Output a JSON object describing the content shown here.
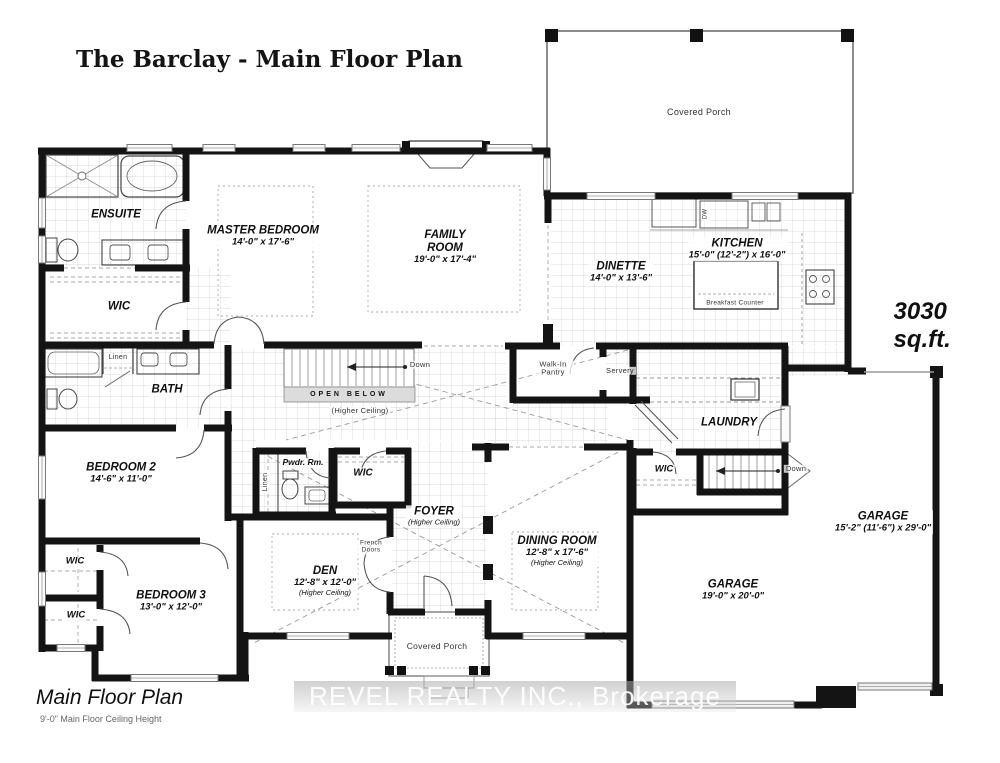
{
  "title": "The Barclay - Main Floor Plan",
  "area_label": "3030 sq.ft.",
  "footer": {
    "plan_name": "Main Floor Plan",
    "ceiling_height": "9'-0\" Main Floor Ceiling Height"
  },
  "watermark": "REVEL REALTY INC., Brokerage",
  "rooms": {
    "ensuite": {
      "name": "ENSUITE"
    },
    "master_bedroom": {
      "name": "MASTER BEDROOM",
      "dims": "14'-0\" x 17'-6\""
    },
    "master_wic": {
      "name": "WIC"
    },
    "family_room": {
      "name": "FAMILY ROOM",
      "dims": "19'-0\" x 17'-4\""
    },
    "dinette": {
      "name": "DINETTE",
      "dims": "14'-0\" x 13'-6\""
    },
    "kitchen": {
      "name": "KITCHEN",
      "dims": "15'-0\" (12'-2\") x 16'-0\""
    },
    "bath": {
      "name": "BATH"
    },
    "bedroom_2": {
      "name": "BEDROOM 2",
      "dims": "14'-6\" x 11'-0\""
    },
    "bedroom_3": {
      "name": "BEDROOM 3",
      "dims": "13'-0\" x 12'-0\""
    },
    "powder_room": {
      "name": "Pwdr. Rm."
    },
    "foyer": {
      "name": "FOYER",
      "note": "(Higher Ceiling)"
    },
    "dining_room": {
      "name": "DINING ROOM",
      "dims": "12'-8\" x 17'-6\"",
      "note": "(Higher Ceiling)"
    },
    "den": {
      "name": "DEN",
      "dims": "12'-8\" x 12'-0\"",
      "note": "(Higher Ceiling)"
    },
    "laundry": {
      "name": "LAUNDRY"
    },
    "garage_side": {
      "name": "GARAGE",
      "dims": "15'-2\" (11'-6\") x 29'-0\""
    },
    "garage_main": {
      "name": "GARAGE",
      "dims": "19'-0\" x 20'-0\""
    },
    "foyer_wic": {
      "name": "WIC"
    },
    "laundry_wic": {
      "name": "WIC"
    },
    "bedroom3_wic_a": {
      "name": "WIC"
    },
    "bedroom3_wic_b": {
      "name": "WIC"
    }
  },
  "annotations": {
    "covered_porch_rear": "Covered Porch",
    "covered_porch_front": "Covered Porch",
    "breakfast_counter": "Breakfast Counter",
    "dishwasher": "DW",
    "open_below": "OPEN BELOW",
    "open_below_note": "(Higher Ceiling)",
    "down_main": "Down",
    "down_garage": "Down",
    "walk_in_pantry": "Walk-In Pantry",
    "servery": "Servery",
    "linen_bath": "Linen",
    "linen_hall": "Linen",
    "french_doors": "French Doors"
  }
}
